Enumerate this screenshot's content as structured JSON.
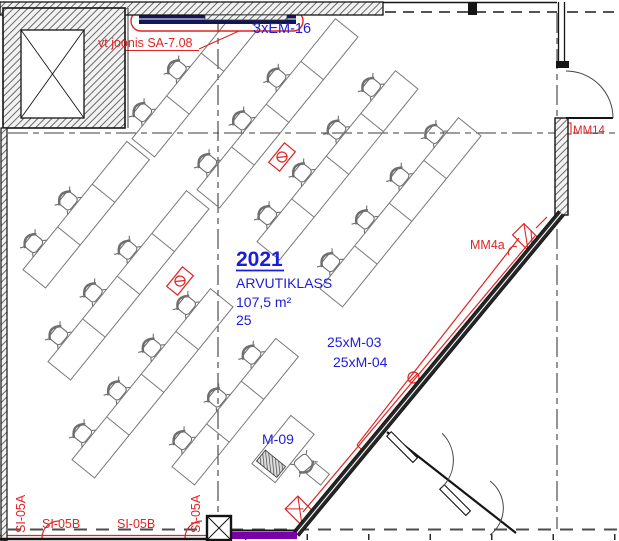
{
  "room": {
    "number": "2021",
    "name": "ARVUTIKLASS",
    "area": "107,5 m²",
    "seats": "25"
  },
  "labels": {
    "top_cable_note": "vt joonis SA-7.08",
    "top_power": "3xEM-16",
    "monitors_a": "25xM-03",
    "monitors_b": "25xM-04",
    "printer": "M-09",
    "wall_box_right": "MM4a",
    "wall_box_door": "MM14",
    "duct_a_left": "SI-05A",
    "duct_b_left": "SI-05B",
    "duct_b_right": "SI-05B",
    "duct_a_right": "SI-05A"
  },
  "colors": {
    "annotation_red": "#e02424",
    "label_blue": "#1d1dd8",
    "wall_dark": "#141414",
    "furniture_gray": "#787878",
    "highlight_purple": "#7a00a8",
    "cable_tray_navy": "#14145a"
  },
  "furniture": {
    "desk_rows": [
      {
        "id": "U1",
        "x": 142,
        "y": 112,
        "seats": 2,
        "tail": 55
      },
      {
        "id": "U2",
        "x": 207,
        "y": 163,
        "seats": 3,
        "tail": 55
      },
      {
        "id": "U3",
        "x": 267,
        "y": 215,
        "seats": 4,
        "tail": 0
      },
      {
        "id": "U4",
        "x": 330,
        "y": 262,
        "seats": 4,
        "tail": 0
      },
      {
        "id": "L1",
        "x": 33,
        "y": 243,
        "seats": 2,
        "tail": 55
      },
      {
        "id": "L2",
        "x": 58,
        "y": 335,
        "seats": 3,
        "tail": 55
      },
      {
        "id": "L3",
        "x": 82,
        "y": 433,
        "seats": 4,
        "tail": 0
      },
      {
        "id": "L4",
        "x": 182,
        "y": 440,
        "seats": 3,
        "tail": 0
      }
    ],
    "total_seats": 25,
    "teacher_station": {
      "x": 283,
      "y": 449,
      "chair_x": 304,
      "chair_y": 464,
      "chair_rot": 140
    },
    "outlets": [
      {
        "x": 282,
        "y": 157
      },
      {
        "x": 180,
        "y": 281
      }
    ]
  }
}
